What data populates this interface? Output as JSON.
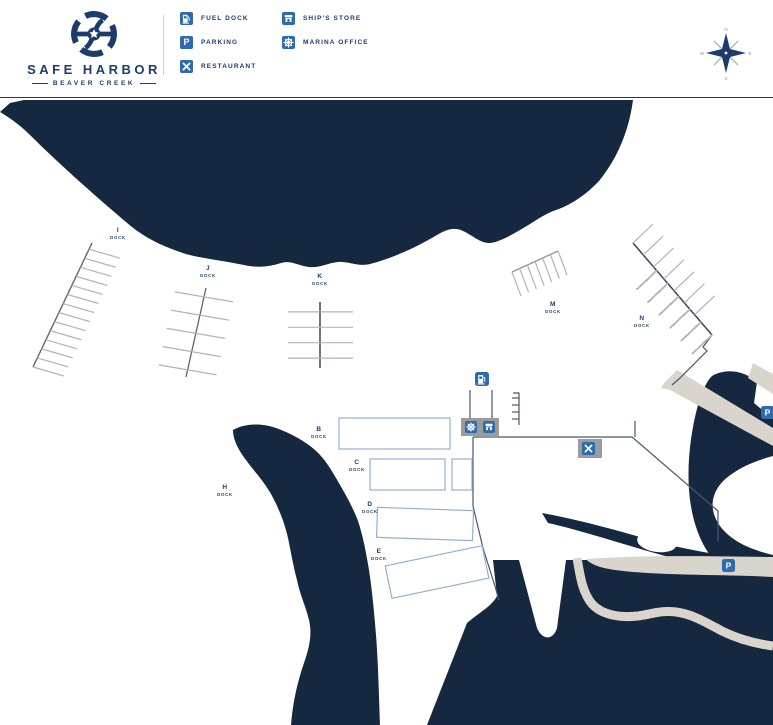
{
  "header": {
    "brand_name": "SAFE HARBOR",
    "brand_location": "BEAVER CREEK",
    "legend": [
      {
        "label": "FUEL DOCK"
      },
      {
        "label": "PARKING"
      },
      {
        "label": "RESTAURANT"
      },
      {
        "label": "SHIP'S STORE"
      },
      {
        "label": "MARINA OFFICE"
      }
    ]
  },
  "compass": {
    "north": "N",
    "east": "E",
    "south": "S",
    "west": "W"
  },
  "icons": {
    "parking_letter": "P"
  },
  "map": {
    "docks": [
      {
        "letter": "B",
        "sub": "DOCK"
      },
      {
        "letter": "C",
        "sub": "DOCK"
      },
      {
        "letter": "D",
        "sub": "DOCK"
      },
      {
        "letter": "E",
        "sub": "DOCK"
      },
      {
        "letter": "H",
        "sub": "DOCK"
      },
      {
        "letter": "I",
        "sub": "DOCK"
      },
      {
        "letter": "J",
        "sub": "DOCK"
      },
      {
        "letter": "K",
        "sub": "DOCK"
      },
      {
        "letter": "M",
        "sub": "DOCK"
      },
      {
        "letter": "N",
        "sub": "DOCK"
      }
    ]
  },
  "colors": {
    "water": "#16283f",
    "navy_text": "#1d3c6b",
    "icon_blue": "#2e6bad",
    "road": "#d9d5cc",
    "dock_outline": "#92b0cd",
    "building_gray": "#9b9b9b"
  }
}
